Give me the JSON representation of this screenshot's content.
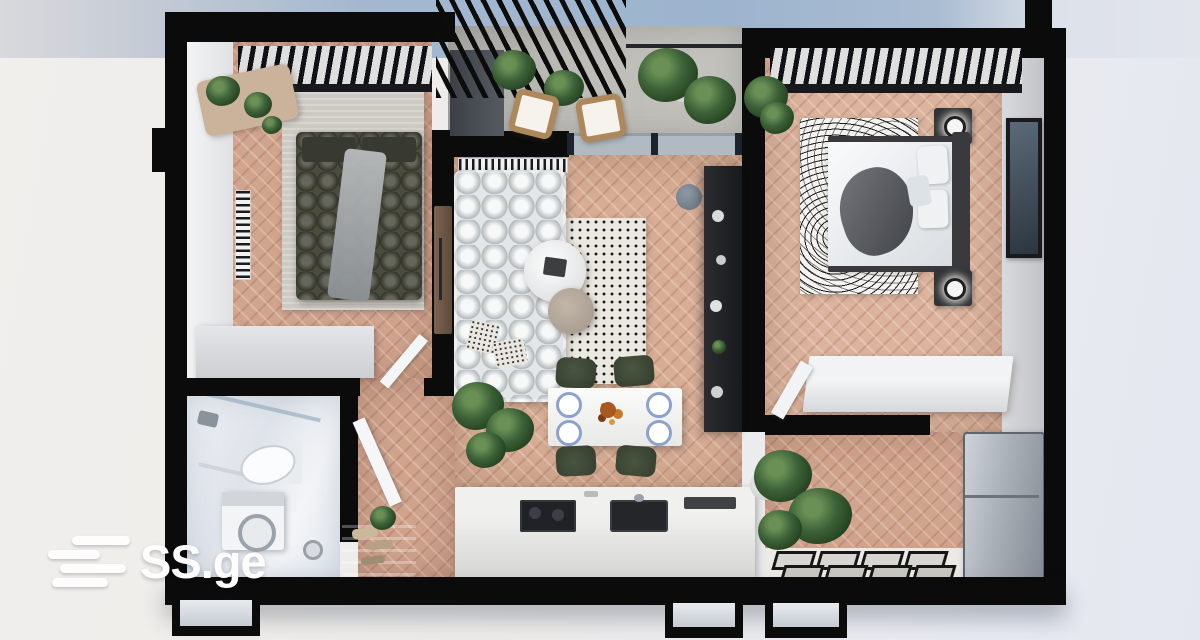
{
  "watermark": {
    "brand": "SS.ge",
    "icon": "ss-ge-stripes-icon"
  },
  "scene": {
    "description": "Top-down 3D architectural render of a furnished one-plus-two-room apartment floor plan on a light studio background with a blue exterior band at the bottom",
    "rooms": [
      "bedroom-left",
      "balcony",
      "bedroom-right",
      "living-room",
      "dining-area",
      "kitchen",
      "bathroom",
      "hallway",
      "entry-hall"
    ]
  },
  "palette": {
    "wall_black": "#0b0b0c",
    "floor_wood": "#d1a48e",
    "floor_balcony": "#b6b5b0",
    "bathroom_tile": "#e9edf2",
    "sofa_white": "#e3e6e7",
    "bed_olive": "#4b4c3e",
    "dining_chair_green": "#42503c",
    "plant_green": "#2f5132",
    "exterior_blue": "#9db4ce",
    "background_left": "#f1efec",
    "background_right": "#e4e7ef",
    "logo_white": "#fdfdfd"
  }
}
